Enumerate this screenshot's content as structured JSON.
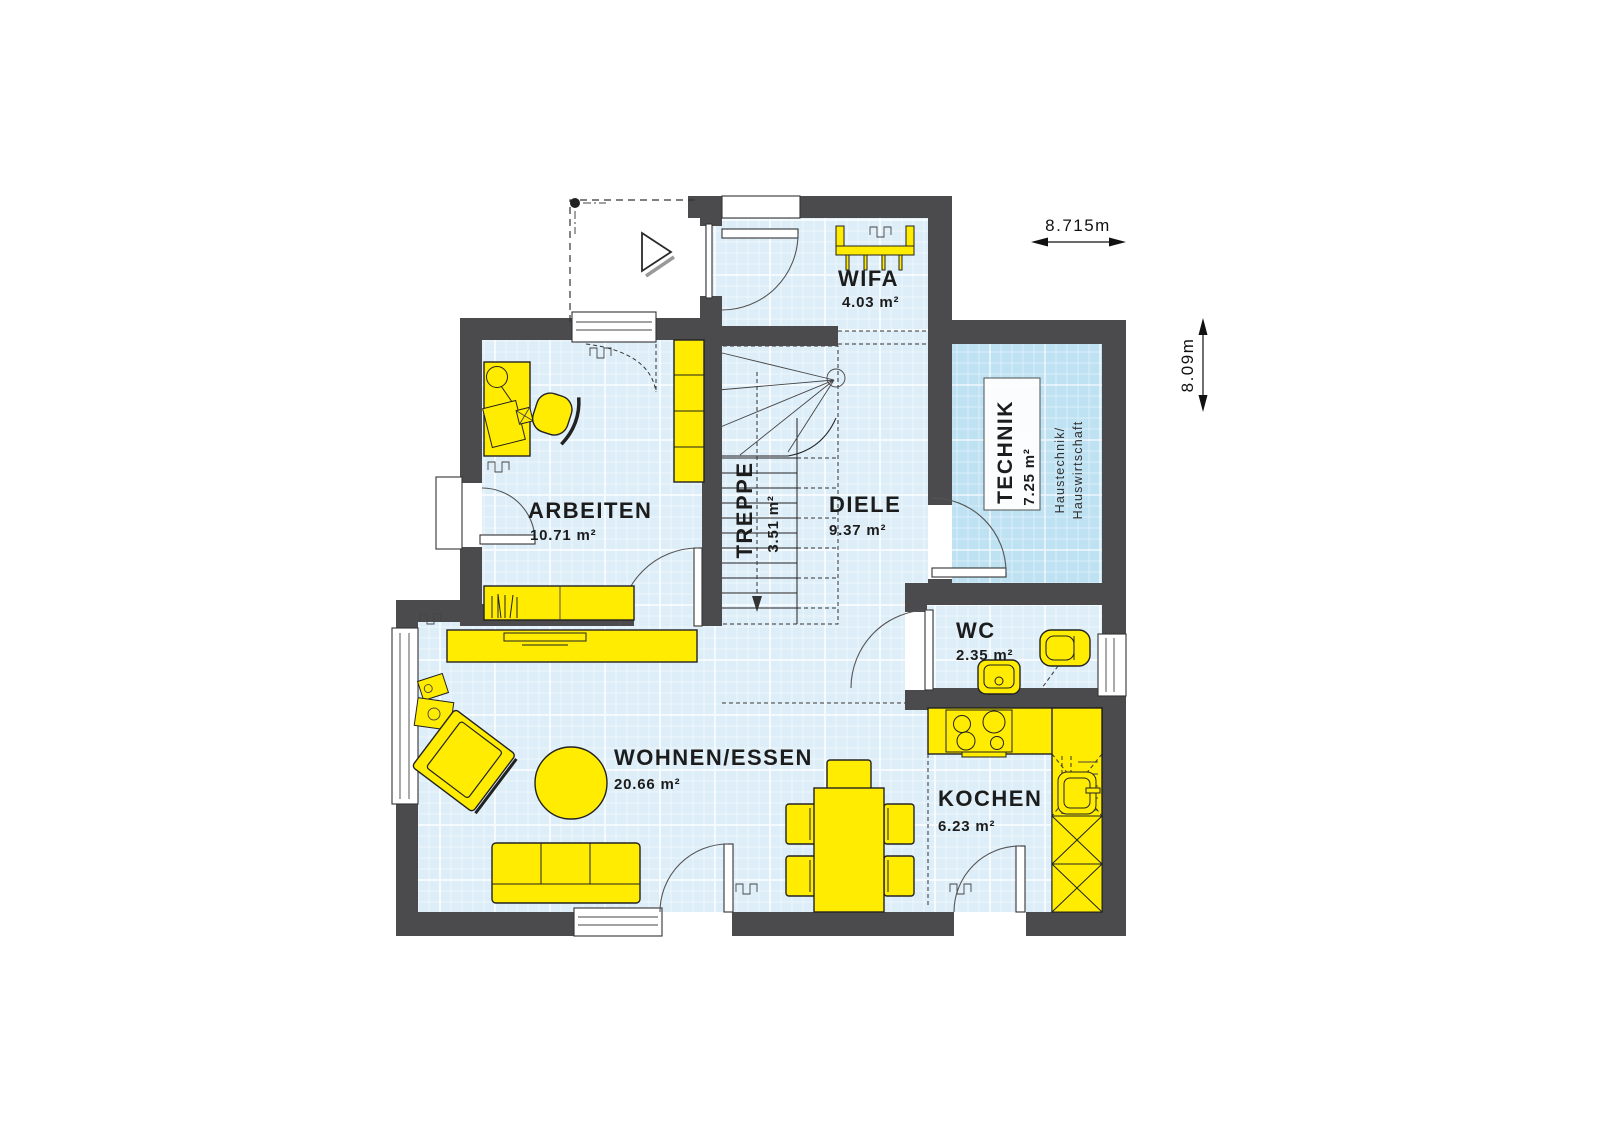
{
  "colors": {
    "wall": "#4b4b4d",
    "floor": "#ddeef9",
    "floor_technik": "#bfe2f3",
    "furniture": "#ffec00"
  },
  "rooms": {
    "wifa": {
      "name": "WIFA",
      "area": "4.03 m²"
    },
    "arbeiten": {
      "name": "ARBEITEN",
      "area": "10.71 m²"
    },
    "treppe": {
      "name": "TREPPE",
      "area": "3.51 m²"
    },
    "diele": {
      "name": "DIELE",
      "area": "9.37 m²"
    },
    "technik": {
      "name": "TECHNIK",
      "area": "7.25 m²",
      "note1": "Haustechnik/",
      "note2": "Hauswirtschaft"
    },
    "wc": {
      "name": "WC",
      "area": "2.35 m²"
    },
    "wohnen_essen": {
      "name": "WOHNEN/ESSEN",
      "area": "20.66 m²"
    },
    "kochen": {
      "name": "KOCHEN",
      "area": "6.23 m²"
    }
  },
  "dimensions": {
    "width": "8.715m",
    "height": "8.09m"
  }
}
